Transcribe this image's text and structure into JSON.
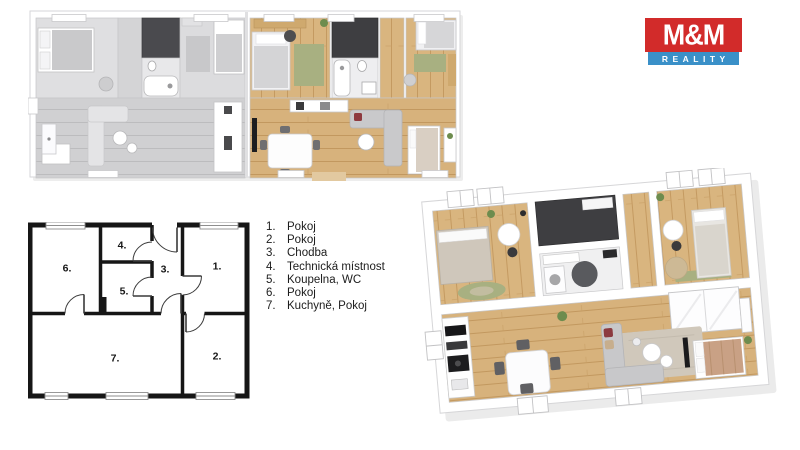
{
  "logo": {
    "name": "M&M",
    "tagline": "REALITY",
    "red": "#d22b2a",
    "blue": "#3a90c8"
  },
  "legend": {
    "items": [
      {
        "num": "1.",
        "label": "Pokoj"
      },
      {
        "num": "2.",
        "label": "Pokoj"
      },
      {
        "num": "3.",
        "label": "Chodba"
      },
      {
        "num": "4.",
        "label": "Technická místnost"
      },
      {
        "num": "5.",
        "label": "Koupelna, WC"
      },
      {
        "num": "6.",
        "label": "Pokoj"
      },
      {
        "num": "7.",
        "label": "Kuchyně, Pokoj"
      }
    ]
  },
  "plan2d": {
    "rooms": [
      {
        "num": "1."
      },
      {
        "num": "2."
      },
      {
        "num": "3."
      },
      {
        "num": "4."
      },
      {
        "num": "5."
      },
      {
        "num": "6."
      },
      {
        "num": "7."
      }
    ]
  },
  "colors": {
    "wood_floor": "#d9b57f",
    "wood_light": "#e3c28f",
    "gray_floor": "#d4d4d6",
    "dark_tech_floor": "#3e3e41",
    "green_rug": "#a8b081",
    "sofa_gray": "#c8c8ca",
    "rug_beige": "#d0c8bb",
    "accent_pillow_red": "#8c3a40",
    "wall_line_2d": "#161616"
  }
}
